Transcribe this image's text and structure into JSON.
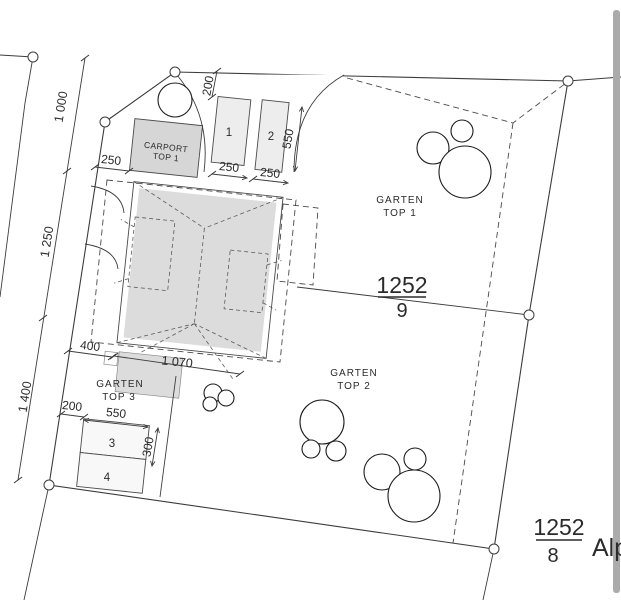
{
  "plan": {
    "parcels": {
      "main": {
        "number": "1252",
        "denominator": "9"
      },
      "neighbor": {
        "number": "1252",
        "denominator": "8"
      }
    },
    "street": {
      "label": "Alp"
    },
    "zones": {
      "carport": {
        "line1": "CARPORT",
        "line2": "TOP 1"
      },
      "garden1": {
        "line1": "GARTEN",
        "line2": "TOP 1"
      },
      "garden2": {
        "line1": "GARTEN",
        "line2": "TOP 2"
      },
      "garden3": {
        "line1": "GARTEN",
        "line2": "TOP 3"
      }
    },
    "parking_spaces": {
      "s1": "1",
      "s2": "2",
      "s3": "3",
      "s4": "4"
    },
    "dimensions": {
      "d1000": "1 000",
      "d1250": "1 250",
      "d1400": "1 400",
      "top_200": "200",
      "top_550": "550",
      "carport_250": "250",
      "stall1_250": "250",
      "stall2_250": "250",
      "house_400": "400",
      "house_1070": "1 070",
      "bottom_200": "200",
      "bottom_550": "550",
      "bottom_300": "300"
    },
    "colors": {
      "parcel_fill": "#ededed",
      "building_fill": "#dcdcdc",
      "carport_fill": "#d6d6d6",
      "line": "#3c3c3c",
      "edge_bar": "#ababab"
    }
  }
}
